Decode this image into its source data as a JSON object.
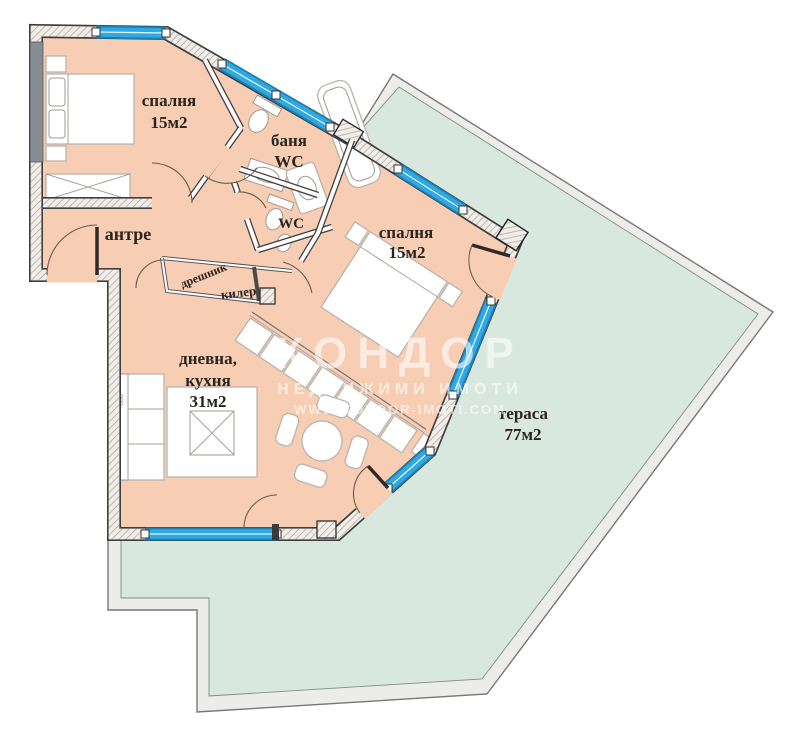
{
  "rooms": {
    "bedroom_top": {
      "name": "спалня",
      "area": "15м2"
    },
    "bathroom": {
      "line1": "баня",
      "line2": "WC"
    },
    "wc": {
      "label": "WC"
    },
    "hallway": {
      "name": "антре"
    },
    "closet": {
      "name": "дрешник"
    },
    "pantry": {
      "name": "килер"
    },
    "living_kitchen": {
      "line1": "дневна,",
      "line2": "кухня",
      "area": "31м2"
    },
    "bedroom_right": {
      "name": "спалня",
      "area": "15м2"
    },
    "terrace": {
      "name": "тераса",
      "area": "77м2"
    }
  },
  "furniture": {
    "sofa_dimension_label": "668"
  },
  "watermark": {
    "brand": "КОНДОР",
    "subtitle": "НЕДВИЖИМИ ИМОТИ",
    "website": "WWW.KONDOR-IMOTI.COM"
  },
  "colors": {
    "interior_fill": "#f7cdb3",
    "terrace_fill": "#d8e8de",
    "terrace_band": "#ececea",
    "window_blue": "#2fa9e2",
    "window_edge": "#1b7fb4",
    "wall_hatch_line": "#b3aaa0"
  }
}
